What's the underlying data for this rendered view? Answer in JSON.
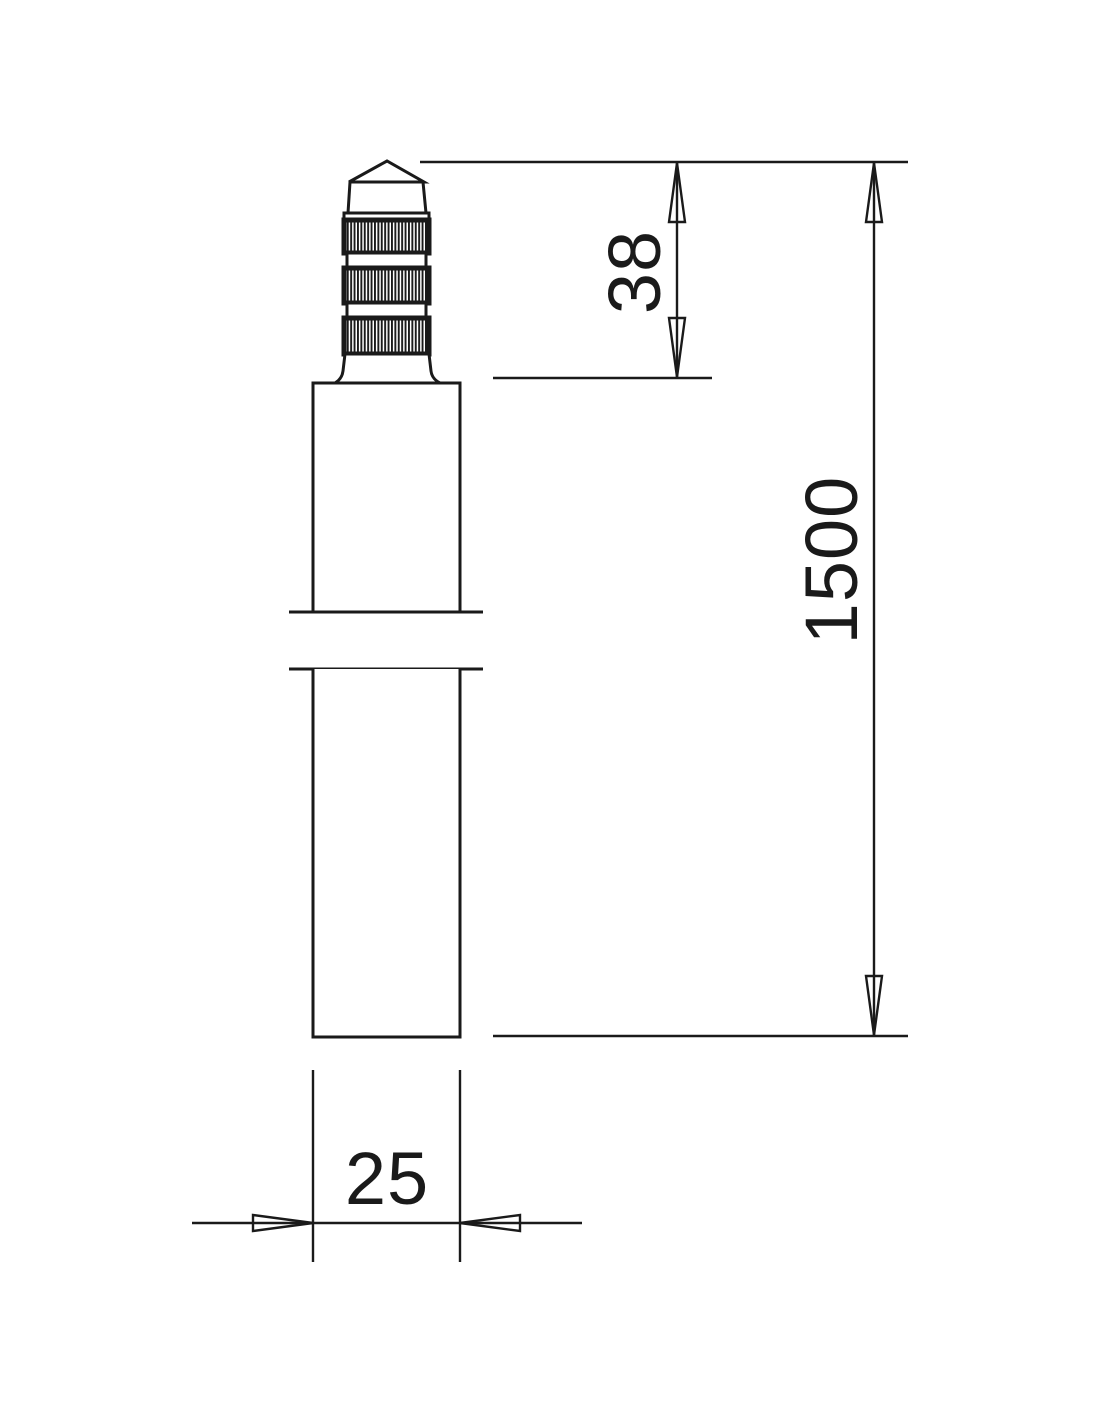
{
  "canvas": {
    "width": 1100,
    "height": 1422,
    "background": "#ffffff",
    "line_color": "#1a1a1a"
  },
  "drawing": {
    "kind": "technical-dimension-drawing",
    "labels": {
      "tip_length": "38",
      "overall_length": "1500",
      "diameter": "25"
    }
  }
}
